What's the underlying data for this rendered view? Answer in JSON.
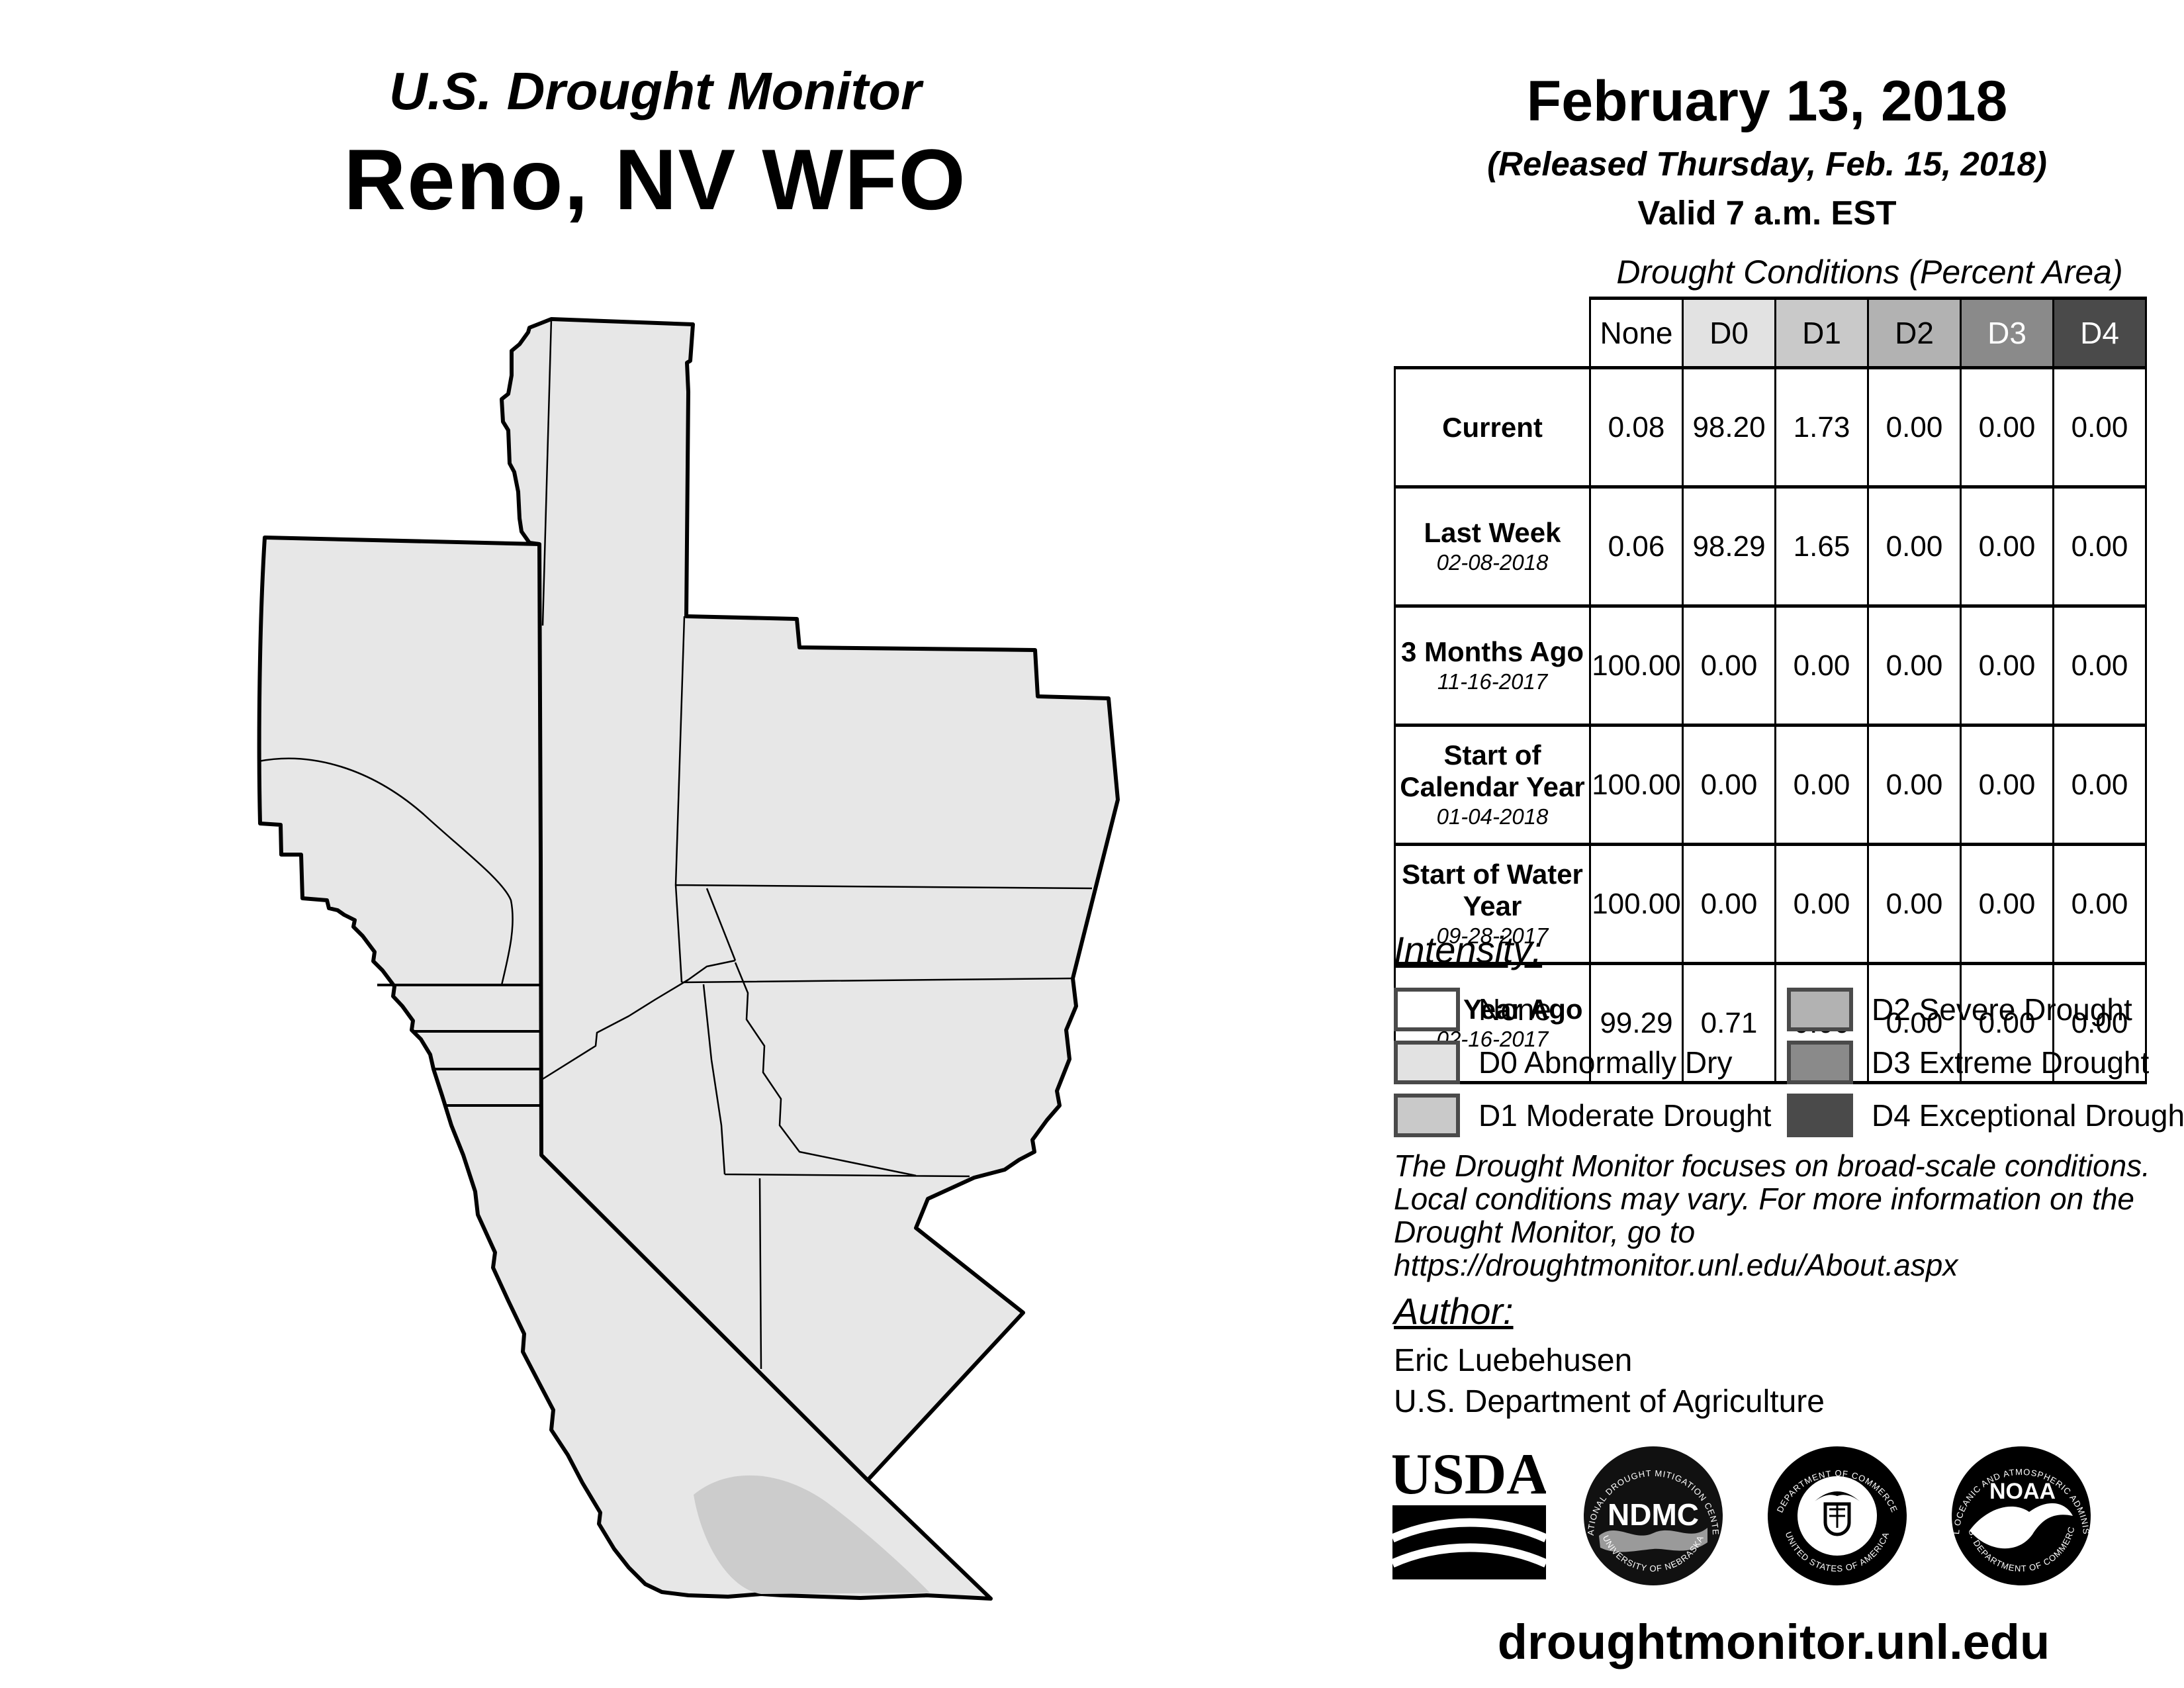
{
  "header": {
    "monitor_title": "U.S. Drought Monitor",
    "region_title": "Reno, NV WFO",
    "date": "February 13, 2018",
    "released": "(Released Thursday, Feb. 15, 2018)",
    "valid": "Valid 7 a.m. EST"
  },
  "table": {
    "title": "Drought Conditions (Percent Area)",
    "columns": [
      "None",
      "D0",
      "D1",
      "D2",
      "D3",
      "D4"
    ],
    "rows": [
      {
        "label": "Current",
        "date": "",
        "values": [
          "0.08",
          "98.20",
          "1.73",
          "0.00",
          "0.00",
          "0.00"
        ]
      },
      {
        "label": "Last Week",
        "date": "02-08-2018",
        "values": [
          "0.06",
          "98.29",
          "1.65",
          "0.00",
          "0.00",
          "0.00"
        ]
      },
      {
        "label": "3 Months Ago",
        "date": "11-16-2017",
        "values": [
          "100.00",
          "0.00",
          "0.00",
          "0.00",
          "0.00",
          "0.00"
        ]
      },
      {
        "label": "Start of Calendar Year",
        "date": "01-04-2018",
        "values": [
          "100.00",
          "0.00",
          "0.00",
          "0.00",
          "0.00",
          "0.00"
        ]
      },
      {
        "label": "Start of Water Year",
        "date": "09-28-2017",
        "values": [
          "100.00",
          "0.00",
          "0.00",
          "0.00",
          "0.00",
          "0.00"
        ]
      },
      {
        "label": "One Year Ago",
        "date": "02-16-2017",
        "values": [
          "99.29",
          "0.71",
          "0.00",
          "0.00",
          "0.00",
          "0.00"
        ]
      }
    ]
  },
  "legend": {
    "title": "Intensity:",
    "items": [
      {
        "label": "None",
        "color": "#ffffff"
      },
      {
        "label": "D0 Abnormally Dry",
        "color": "#e2e2e2"
      },
      {
        "label": "D1 Moderate Drought",
        "color": "#c9c9c9"
      },
      {
        "label": "D2 Severe Drought",
        "color": "#b2b2b2"
      },
      {
        "label": "D3 Extreme Drought",
        "color": "#8a8a8a"
      },
      {
        "label": "D4 Exceptional Drought",
        "color": "#4a4a4a"
      }
    ]
  },
  "disclaimer": {
    "line1": "The Drought Monitor focuses on broad-scale conditions.",
    "line2": "Local conditions may vary. For more information on the",
    "line3": "Drought Monitor, go to https://droughtmonitor.unl.edu/About.aspx"
  },
  "author": {
    "title": "Author:",
    "name": "Eric Luebehusen",
    "org": "U.S. Department of Agriculture"
  },
  "footer": {
    "url": "droughtmonitor.unl.edu"
  },
  "logos": {
    "usda": {
      "text": "USDA"
    },
    "ndmc": {
      "ring_top": "NATIONAL DROUGHT MITIGATION CENTER",
      "center": "NDMC",
      "ring_bottom": "UNIVERSITY OF NEBRASKA"
    },
    "doc": {
      "ring_top": "DEPARTMENT OF COMMERCE",
      "ring_bottom": "UNITED STATES OF AMERICA"
    },
    "noaa": {
      "ring_top": "NATIONAL OCEANIC AND ATMOSPHERIC ADMINISTRATION",
      "center": "NOAA",
      "ring_bottom": "U.S. DEPARTMENT OF COMMERCE"
    }
  },
  "map": {
    "region": "Reno, NV WFO forecast area",
    "colors": {
      "d0_fill": "#e7e7e7",
      "d1_fill": "#cccccc",
      "border": "#000000"
    }
  }
}
